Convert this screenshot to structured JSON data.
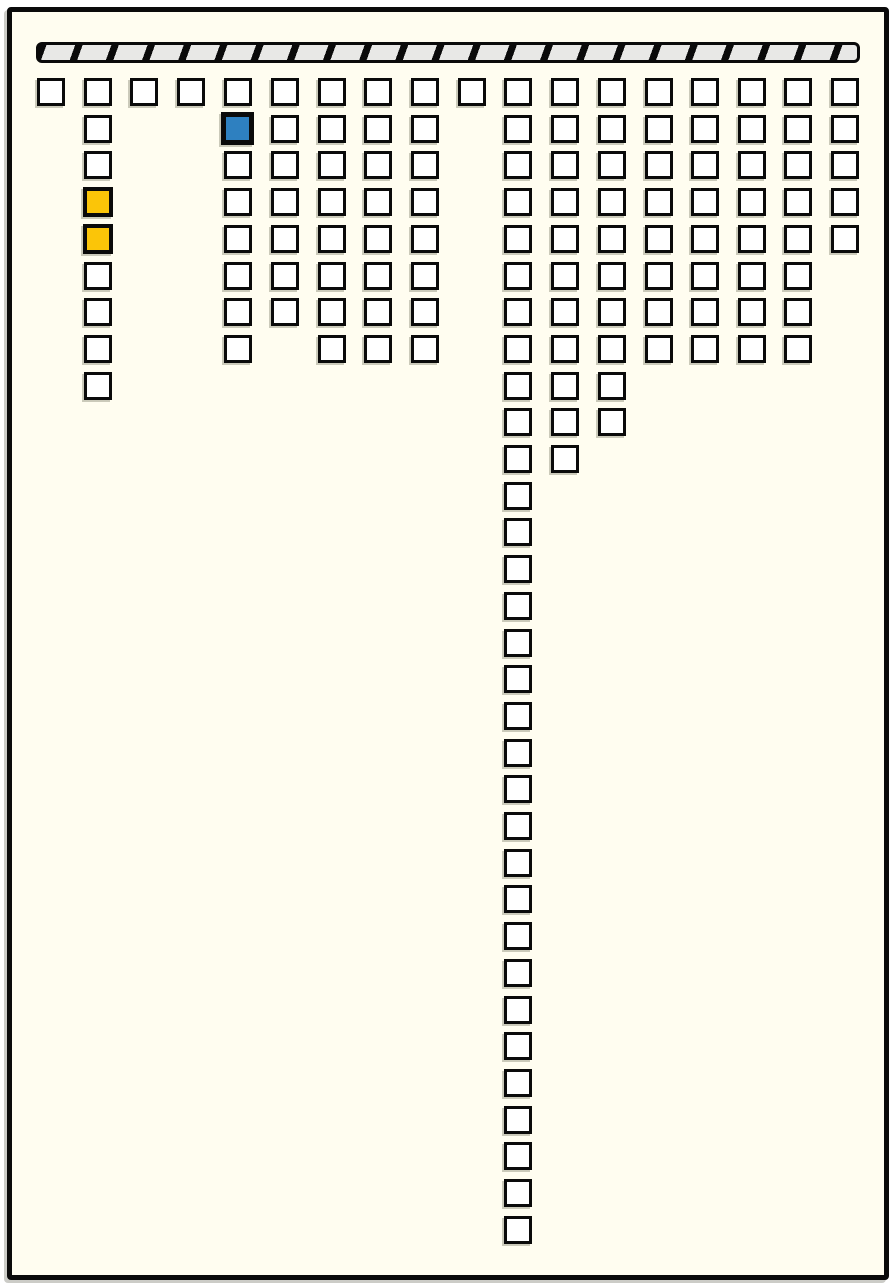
{
  "board": {
    "background": "#FFFDF0",
    "border_color": "#0A0A0A",
    "outer_margin_color": "#FFFFFF"
  },
  "hatched_bar": {
    "x": 36,
    "y": 42,
    "width": 824,
    "height": 21,
    "segment_fill": "#E8E8E6",
    "line_color": "#0A0A0A",
    "segment_pitch": 34,
    "separator_width": 7,
    "slant_deg": 110
  },
  "grid": {
    "square_size": 28,
    "border_width": 3,
    "row_y_start": 78,
    "row_pitch": 36.7,
    "default_fill": "#FFFFFF",
    "border_color": "#0A0A0A",
    "columns": [
      {
        "x": 37,
        "count": 1
      },
      {
        "x": 84,
        "count": 9
      },
      {
        "x": 130,
        "count": 1
      },
      {
        "x": 177,
        "count": 1
      },
      {
        "x": 224,
        "count": 8
      },
      {
        "x": 271,
        "count": 7
      },
      {
        "x": 318,
        "count": 8
      },
      {
        "x": 364,
        "count": 8
      },
      {
        "x": 411,
        "count": 8
      },
      {
        "x": 458,
        "count": 1
      },
      {
        "x": 504,
        "count": 32
      },
      {
        "x": 551,
        "count": 11
      },
      {
        "x": 598,
        "count": 10
      },
      {
        "x": 645,
        "count": 8
      },
      {
        "x": 691,
        "count": 8
      },
      {
        "x": 738,
        "count": 8
      },
      {
        "x": 784,
        "count": 8
      },
      {
        "x": 831,
        "count": 5
      }
    ],
    "special_cells": [
      {
        "col": 4,
        "row": 1,
        "fill": "#2E80C0",
        "size": 33,
        "border_width": 5,
        "name": "selected-cell-blue"
      },
      {
        "col": 1,
        "row": 3,
        "fill": "#FBC508",
        "size": 30,
        "border_width": 4,
        "name": "highlighted-cell-yellow-1"
      },
      {
        "col": 1,
        "row": 4,
        "fill": "#FBC508",
        "size": 30,
        "border_width": 4,
        "name": "highlighted-cell-yellow-2"
      }
    ]
  }
}
